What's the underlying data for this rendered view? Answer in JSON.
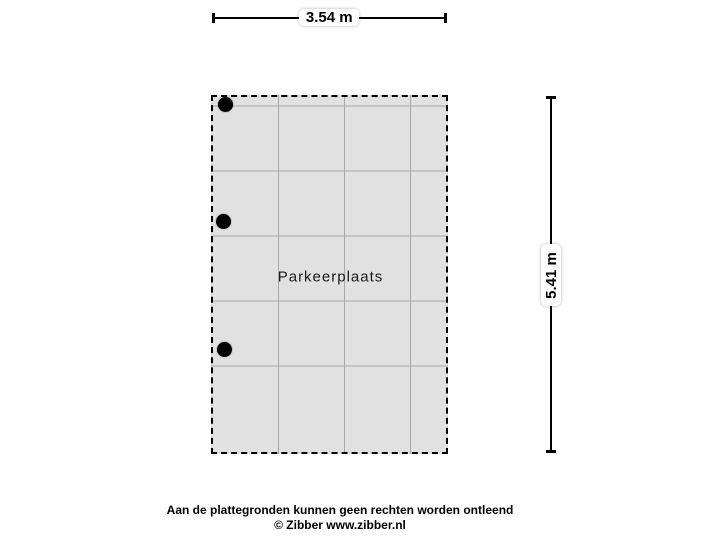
{
  "floorplan": {
    "room_label": "Parkeerplaats",
    "width_dimension": "3.54 m",
    "height_dimension": "5.41 m",
    "marker_dots": [
      {
        "x": 12,
        "y": 7
      },
      {
        "x": 10.5,
        "y": 124.5
      },
      {
        "x": 11,
        "y": 252.5
      }
    ],
    "colors": {
      "room_fill": "#e1e1e1",
      "grid_line": "#a8a8a8",
      "outline": "#000000"
    }
  },
  "footer": {
    "disclaimer": "Aan de plattegronden kunnen geen rechten worden ontleend",
    "copyright": "© Zibber www.zibber.nl"
  }
}
